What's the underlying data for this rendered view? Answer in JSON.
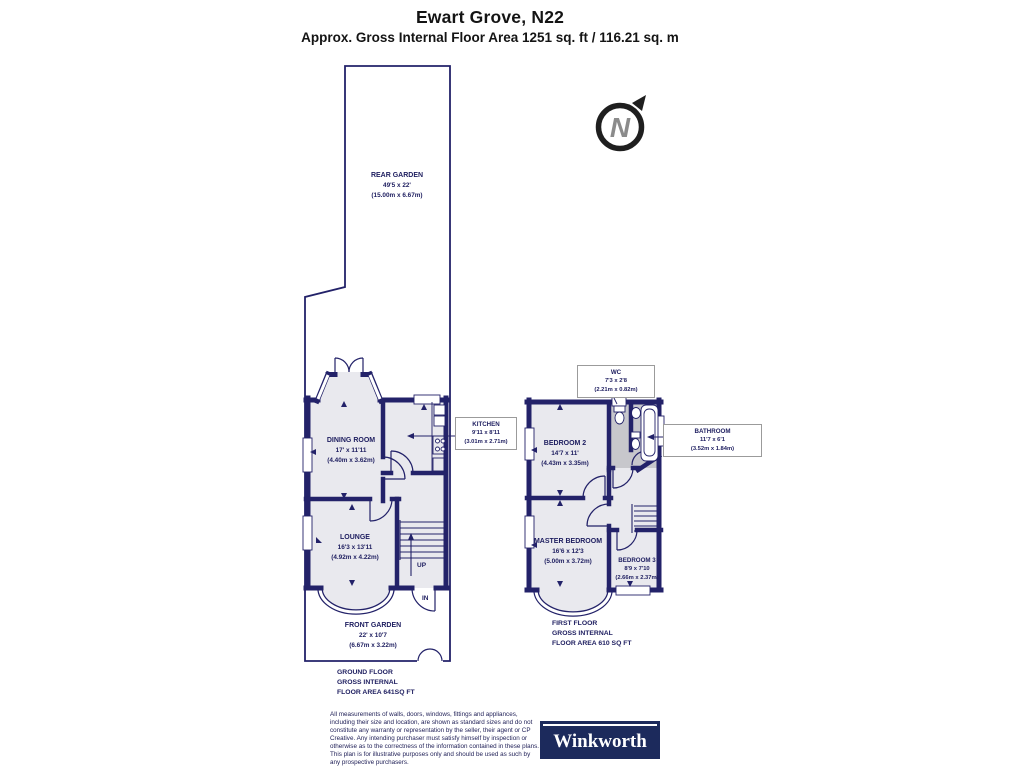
{
  "header": {
    "title": "Ewart Grove, N22",
    "subtitle": "Approx. Gross Internal Floor Area 1251 sq. ft / 116.21 sq. m"
  },
  "compass": {
    "letter": "N"
  },
  "ground_floor": {
    "rear_garden": {
      "name": "REAR GARDEN",
      "imperial": "49'5 x 22'",
      "metric": "(15.00m x 6.67m)"
    },
    "dining_room": {
      "name": "DINING ROOM",
      "imperial": "17' x 11'11",
      "metric": "(4.40m x 3.62m)"
    },
    "kitchen": {
      "name": "KITCHEN",
      "imperial": "9'11 x 8'11",
      "metric": "(3.01m x 2.71m)"
    },
    "lounge": {
      "name": "LOUNGE",
      "imperial": "16'3 x 13'11",
      "metric": "(4.92m x 4.22m)"
    },
    "front_garden": {
      "name": "FRONT GARDEN",
      "imperial": "22' x 10'7",
      "metric": "(6.67m x 3.22m)"
    },
    "stairs_label": "UP",
    "entrance_label": "IN",
    "area_lines": [
      "GROUND FLOOR",
      "GROSS INTERNAL",
      "FLOOR AREA 641SQ FT"
    ]
  },
  "first_floor": {
    "wc": {
      "name": "WC",
      "imperial": "7'3 x 2'8",
      "metric": "(2.21m x 0.82m)"
    },
    "bedroom_2": {
      "name": "BEDROOM 2",
      "imperial": "14'7 x 11'",
      "metric": "(4.43m x 3.35m)"
    },
    "bathroom": {
      "name": "BATHROOM",
      "imperial": "11'7 x 6'1",
      "metric": "(3.52m x 1.84m)"
    },
    "master_bedroom": {
      "name": "MASTER BEDROOM",
      "imperial": "16'6 x 12'3",
      "metric": "(5.00m x 3.72m)"
    },
    "bedroom_3": {
      "name": "BEDROOM 3",
      "imperial": "8'9 x 7'10",
      "metric": "(2.66m x 2.37m)"
    },
    "area_lines": [
      "FIRST FLOOR",
      "GROSS INTERNAL",
      "FLOOR AREA 610 SQ FT"
    ]
  },
  "footer": {
    "disclaimer": "All measurements of walls, doors, windows, fittings and appliances, including their size and location, are shown as standard sizes and do not constitute any warranty or representation by the seller, their agent or CP Creative. Any intending purchaser must satisfy himself by inspection or otherwise as to the correctness of the information contained in these plans. This plan is for illustrative purposes only and should be used as such by any prospective purchasers.",
    "brand": "Winkworth"
  },
  "colors": {
    "wall": "#232269",
    "room_fill": "#e9e9ee",
    "wet_room_fill": "#c7c7cc",
    "label_text": "#1d1d5f",
    "logo_bg": "#1c2a5c"
  }
}
